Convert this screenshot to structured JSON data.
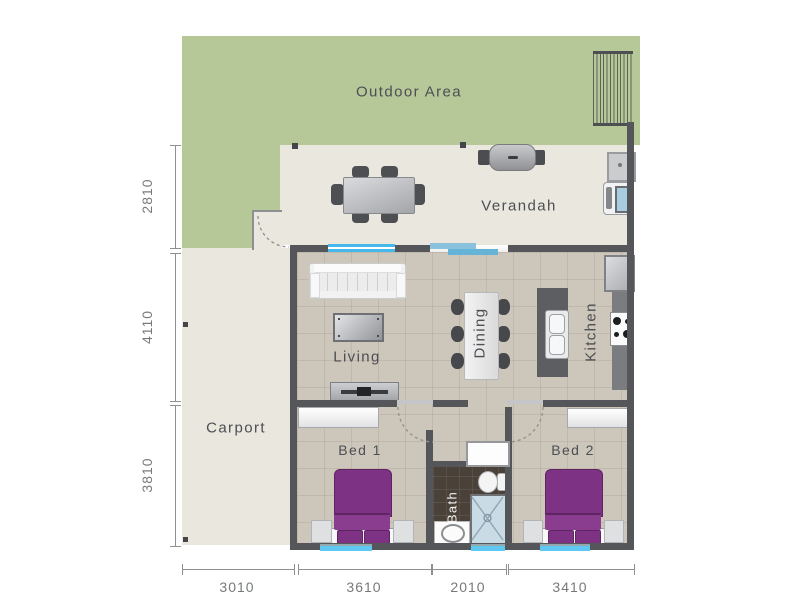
{
  "rooms": {
    "outdoor": {
      "label": "Outdoor Area"
    },
    "verandah": {
      "label": "Verandah"
    },
    "living": {
      "label": "Living"
    },
    "dining": {
      "label": "Dining"
    },
    "kitchen": {
      "label": "Kitchen"
    },
    "carport": {
      "label": "Carport"
    },
    "bed1": {
      "label": "Bed 1"
    },
    "bed2": {
      "label": "Bed 2"
    },
    "bath": {
      "label": "Bath"
    }
  },
  "dimensions": {
    "left": [
      "2810",
      "4110",
      "3810"
    ],
    "bottom": [
      "3010",
      "3610",
      "2010",
      "3410"
    ]
  },
  "colors": {
    "grass": "#b6c898",
    "outdoor-floor": "#e9e7de",
    "interior-floor": "#cdc6bb",
    "bath-floor": "#4a4138",
    "wall": "#55565a",
    "window": "#45b8ec",
    "window-soft": "#7cb8d6",
    "bed": "#7d3284",
    "shower": "#c9dce6",
    "label": "#4c4f53",
    "dim": "#77797b"
  }
}
